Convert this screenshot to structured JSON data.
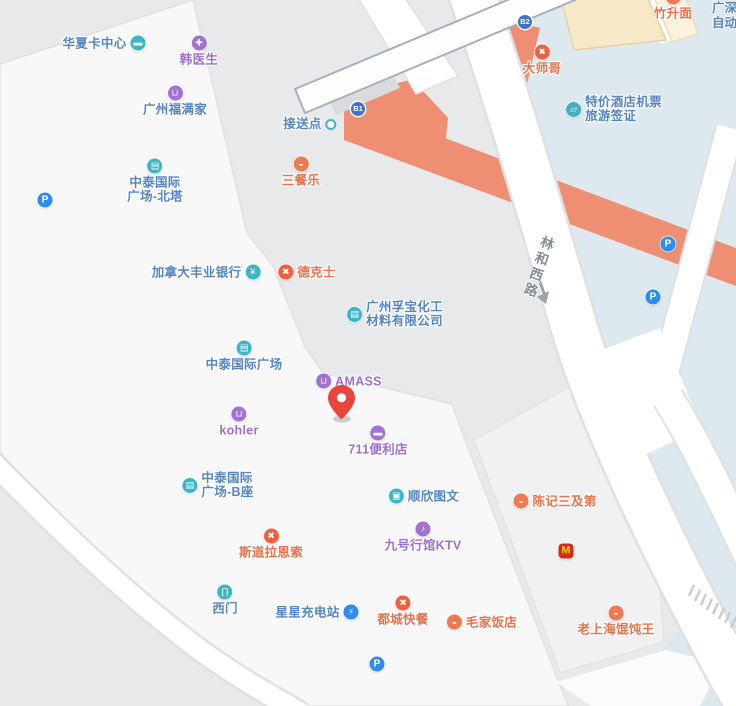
{
  "app": "map-view",
  "colors": {
    "map_bg": "#E8E9EA",
    "block_white": "#F8F8F9",
    "block_gray": "#F0F1F2",
    "plaza_blue": "#DEE8EF",
    "road_orange": "#EE8E72",
    "cream_building": "#F7E9C8",
    "poi_blue_text": "#5585C5",
    "poi_purple_text": "#9C6FD0",
    "poi_orange_text": "#E7724B",
    "icon_teal": "#3CB6C3",
    "icon_purple": "#A171D6",
    "icon_orange": "#F0794F",
    "icon_parking_blue": "#2E8CEE",
    "exit_badge_blue": "#4072CC",
    "mc_red": "#D02C1E",
    "mc_yellow": "#FFC400",
    "pin_red": "#E8453C",
    "road_label_gray": "#868D95"
  },
  "roads": {
    "linhe": {
      "label": "林和西路"
    }
  },
  "corner_label": "广深\n自动",
  "pin": {
    "name": "location-pin"
  },
  "pois": [
    {
      "name": "huaxia-card-center",
      "label": "华夏卡中心",
      "text_color": "#5585C5",
      "layout": "icon-right",
      "x": 104,
      "y": 43,
      "icon": {
        "name": "card-icon",
        "glyph": "▬",
        "bg": "#3CB6C3"
      }
    },
    {
      "name": "han-doctor",
      "label": "韩医生",
      "text_color": "#9C6FD0",
      "layout": "top",
      "x": 199,
      "y": 51,
      "icon": {
        "name": "medical-icon",
        "glyph": "✚",
        "bg": "#A171D6"
      }
    },
    {
      "name": "guangzhou-fumanjia",
      "label": "广州福满家",
      "text_color": "#5585C5",
      "layout": "top",
      "x": 175,
      "y": 101,
      "icon": {
        "name": "shopping-bag-icon",
        "glyph": "⊔",
        "bg": "#A171D6"
      }
    },
    {
      "name": "zhongtai-plaza-north-tower",
      "label": "中泰国际\n广场-北塔",
      "text_color": "#5585C5",
      "layout": "top",
      "x": 155,
      "y": 181,
      "icon": {
        "name": "building-icon",
        "glyph": "▤",
        "bg": "#3CB6C3"
      }
    },
    {
      "name": "shuttle-point",
      "label": "接送点",
      "text_color": "#5585C5",
      "layout": "icon-right",
      "x": 310,
      "y": 124,
      "icon": {
        "name": "shuttle-dot-icon",
        "glyph": "",
        "bg": "#fff",
        "cls": "dot"
      }
    },
    {
      "name": "sancanle",
      "label": "三餐乐",
      "text_color": "#E7724B",
      "layout": "top",
      "x": 301,
      "y": 172,
      "icon": {
        "name": "bowl-icon",
        "glyph": "◒",
        "bg": "#F0794F"
      }
    },
    {
      "name": "scotiabank-canada",
      "label": "加拿大丰业银行",
      "text_color": "#5585C5",
      "layout": "icon-right",
      "x": 206,
      "y": 272,
      "icon": {
        "name": "bank-yuan-icon",
        "glyph": "¥",
        "bg": "#3CB6C3"
      }
    },
    {
      "name": "dicos",
      "label": "德克士",
      "text_color": "#E7724B",
      "layout": "icon-left",
      "x": 307,
      "y": 272,
      "icon": {
        "name": "cutlery-icon",
        "glyph": "✖",
        "bg": "#F0603F"
      }
    },
    {
      "name": "fubao-chemical",
      "label": "广州孚宝化工\n材料有限公司",
      "text_color": "#5585C5",
      "layout": "icon-left",
      "x": 395,
      "y": 314,
      "align": "left",
      "icon": {
        "name": "building-icon",
        "glyph": "▤",
        "bg": "#3CB6C3"
      }
    },
    {
      "name": "zhongtai-plaza",
      "label": "中泰国际广场",
      "text_color": "#5585C5",
      "layout": "top",
      "x": 244,
      "y": 356,
      "icon": {
        "name": "building-icon",
        "glyph": "▤",
        "bg": "#3CB6C3"
      }
    },
    {
      "name": "amass",
      "label": "AMASS",
      "text_color": "#9C6FD0",
      "layout": "icon-left",
      "x": 349,
      "y": 381,
      "icon": {
        "name": "shopping-bag-icon",
        "glyph": "⊔",
        "bg": "#A171D6"
      }
    },
    {
      "name": "kohler",
      "label": "kohler",
      "text_color": "#9C6FD0",
      "layout": "top",
      "x": 239,
      "y": 422,
      "icon": {
        "name": "shopping-bag-icon",
        "glyph": "⊔",
        "bg": "#A171D6"
      }
    },
    {
      "name": "711-store",
      "label": "711便利店",
      "text_color": "#9C6FD0",
      "layout": "top",
      "x": 378,
      "y": 441,
      "icon": {
        "name": "storefront-icon",
        "glyph": "▬",
        "bg": "#A171D6"
      }
    },
    {
      "name": "zhongtai-plaza-b",
      "label": "中泰国际\n广场-B座",
      "text_color": "#5585C5",
      "layout": "icon-left",
      "x": 218,
      "y": 485,
      "align": "left",
      "icon": {
        "name": "building-icon",
        "glyph": "▤",
        "bg": "#3CB6C3"
      }
    },
    {
      "name": "shunxin-graphics",
      "label": "顺欣图文",
      "text_color": "#5585C5",
      "layout": "icon-left",
      "x": 424,
      "y": 496,
      "icon": {
        "name": "printer-icon",
        "glyph": "▣",
        "bg": "#3CB6C3"
      }
    },
    {
      "name": "chenji-sanjidi",
      "label": "陈记三及第",
      "text_color": "#E7724B",
      "layout": "icon-left",
      "x": 555,
      "y": 501,
      "icon": {
        "name": "bowl-icon",
        "glyph": "◒",
        "bg": "#F0794F"
      }
    },
    {
      "name": "stora-enso",
      "label": "斯道拉恩索",
      "text_color": "#E7724B",
      "layout": "top",
      "x": 271,
      "y": 544,
      "icon": {
        "name": "cutlery-icon",
        "glyph": "✖",
        "bg": "#F0603F"
      }
    },
    {
      "name": "jiuhao-ktv",
      "label": "九号行馆KTV",
      "text_color": "#9C6FD0",
      "layout": "top",
      "x": 423,
      "y": 537,
      "icon": {
        "name": "microphone-icon",
        "glyph": "♪",
        "bg": "#A171D6"
      }
    },
    {
      "name": "mcdonalds",
      "label": "",
      "text_color": "",
      "layout": "only",
      "x": 566,
      "y": 551,
      "icon": {
        "name": "mcdonalds-icon",
        "glyph": "M",
        "bg": "#D02C1E",
        "cls": "mc"
      }
    },
    {
      "name": "west-gate",
      "label": "西门",
      "text_color": "#5585C5",
      "layout": "top",
      "x": 225,
      "y": 600,
      "icon": {
        "name": "gate-icon",
        "glyph": "∏",
        "bg": "#3CB6C3"
      }
    },
    {
      "name": "xingxing-charging",
      "label": "星星充电站",
      "text_color": "#5585C5",
      "layout": "icon-right",
      "x": 317,
      "y": 612,
      "icon": {
        "name": "charging-icon",
        "glyph": "⚡",
        "bg": "#2E8CEE"
      }
    },
    {
      "name": "ducheng-fastfood",
      "label": "都城快餐",
      "text_color": "#E7724B",
      "layout": "top",
      "x": 403,
      "y": 611,
      "icon": {
        "name": "cutlery-icon",
        "glyph": "✖",
        "bg": "#F0603F"
      }
    },
    {
      "name": "maojia-restaurant",
      "label": "毛家饭店",
      "text_color": "#E7724B",
      "layout": "icon-left",
      "x": 482,
      "y": 622,
      "icon": {
        "name": "bowl-icon",
        "glyph": "◒",
        "bg": "#F0794F"
      }
    },
    {
      "name": "laoshanghai-wonton",
      "label": "老上海馄饨王",
      "text_color": "#E7724B",
      "layout": "top",
      "x": 616,
      "y": 621,
      "icon": {
        "name": "bowl-icon",
        "glyph": "◒",
        "bg": "#F0794F"
      }
    },
    {
      "name": "dashige",
      "label": "大师哥",
      "text_color": "#E7724B",
      "layout": "top",
      "x": 542,
      "y": 60,
      "icon": {
        "name": "cutlery-icon",
        "glyph": "✖",
        "bg": "#F0603F"
      }
    },
    {
      "name": "discount-hotel-tickets",
      "label": "特价酒店机票\n旅游签证",
      "text_color": "#5585C5",
      "layout": "icon-left",
      "x": 614,
      "y": 109,
      "align": "left",
      "icon": {
        "name": "ticket-icon",
        "glyph": "▱",
        "bg": "#45AFC4"
      }
    },
    {
      "name": "zhushengmian",
      "label": "竹升面",
      "text_color": "#E7724B",
      "layout": "top",
      "x": 673,
      "y": 5,
      "icon": {
        "name": "bowl-icon",
        "glyph": "◒",
        "bg": "#F0794F"
      }
    },
    {
      "name": "exit-b1",
      "label": "",
      "text_color": "",
      "layout": "only",
      "x": 358,
      "y": 109,
      "icon": {
        "name": "subway-exit-b1-badge",
        "glyph": "B1",
        "bg": "#4072CC",
        "cls": "badge"
      }
    },
    {
      "name": "exit-b2",
      "label": "",
      "text_color": "",
      "layout": "only",
      "x": 525,
      "y": 22,
      "icon": {
        "name": "subway-exit-b2-badge",
        "glyph": "B2",
        "bg": "#4072CC",
        "cls": "badge"
      }
    },
    {
      "name": "parking-1",
      "label": "",
      "text_color": "",
      "layout": "only",
      "x": 45,
      "y": 200,
      "icon": {
        "name": "parking-icon",
        "glyph": "P",
        "bg": "#2E8CEE",
        "cls": "parking"
      }
    },
    {
      "name": "parking-2",
      "label": "",
      "text_color": "",
      "layout": "only",
      "x": 668,
      "y": 244,
      "icon": {
        "name": "parking-icon",
        "glyph": "P",
        "bg": "#2E8CEE",
        "cls": "parking"
      }
    },
    {
      "name": "parking-3",
      "label": "",
      "text_color": "",
      "layout": "only",
      "x": 653,
      "y": 297,
      "icon": {
        "name": "parking-icon",
        "glyph": "P",
        "bg": "#2E8CEE",
        "cls": "parking"
      }
    },
    {
      "name": "parking-4",
      "label": "",
      "text_color": "",
      "layout": "only",
      "x": 377,
      "y": 664,
      "icon": {
        "name": "parking-icon",
        "glyph": "P",
        "bg": "#2E8CEE",
        "cls": "parking"
      }
    }
  ]
}
